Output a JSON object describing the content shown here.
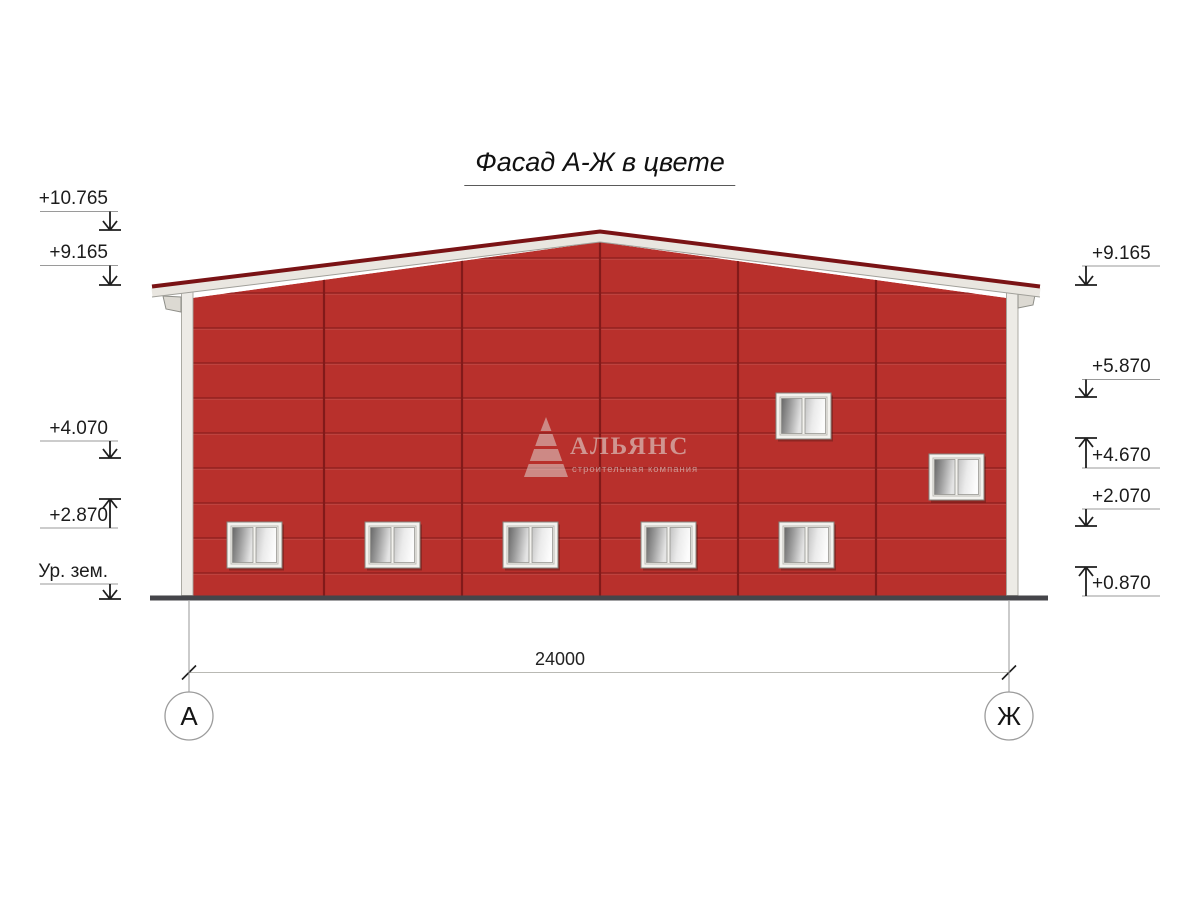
{
  "title": "Фасад А-Ж в цвете",
  "logo": {
    "name": "АЛЬЯНС",
    "tagline": "строительная компания"
  },
  "levels_left": [
    {
      "label": "+10.765",
      "direction": "down"
    },
    {
      "label": "+9.165",
      "direction": "down"
    },
    {
      "label": "+4.070",
      "direction": "down"
    },
    {
      "label": "+2.870",
      "direction": "up"
    },
    {
      "label": "Ур. зем.",
      "direction": "down"
    }
  ],
  "levels_right": [
    {
      "label": "+9.165",
      "direction": "down"
    },
    {
      "label": "+5.870",
      "direction": "down"
    },
    {
      "label": "+4.670",
      "direction": "up"
    },
    {
      "label": "+2.070",
      "direction": "down"
    },
    {
      "label": "+0.870",
      "direction": "up"
    }
  ],
  "dimension": {
    "overall_width_mm": "24000"
  },
  "axes": {
    "left": "А",
    "right": "Ж"
  },
  "colors": {
    "facade_red": "#b8302c",
    "panel_seam_red": "#8c1e1d",
    "roof_cap_red": "#7a1315",
    "fascia_white": "#e9e6e0",
    "ground_dark": "#45454a"
  }
}
